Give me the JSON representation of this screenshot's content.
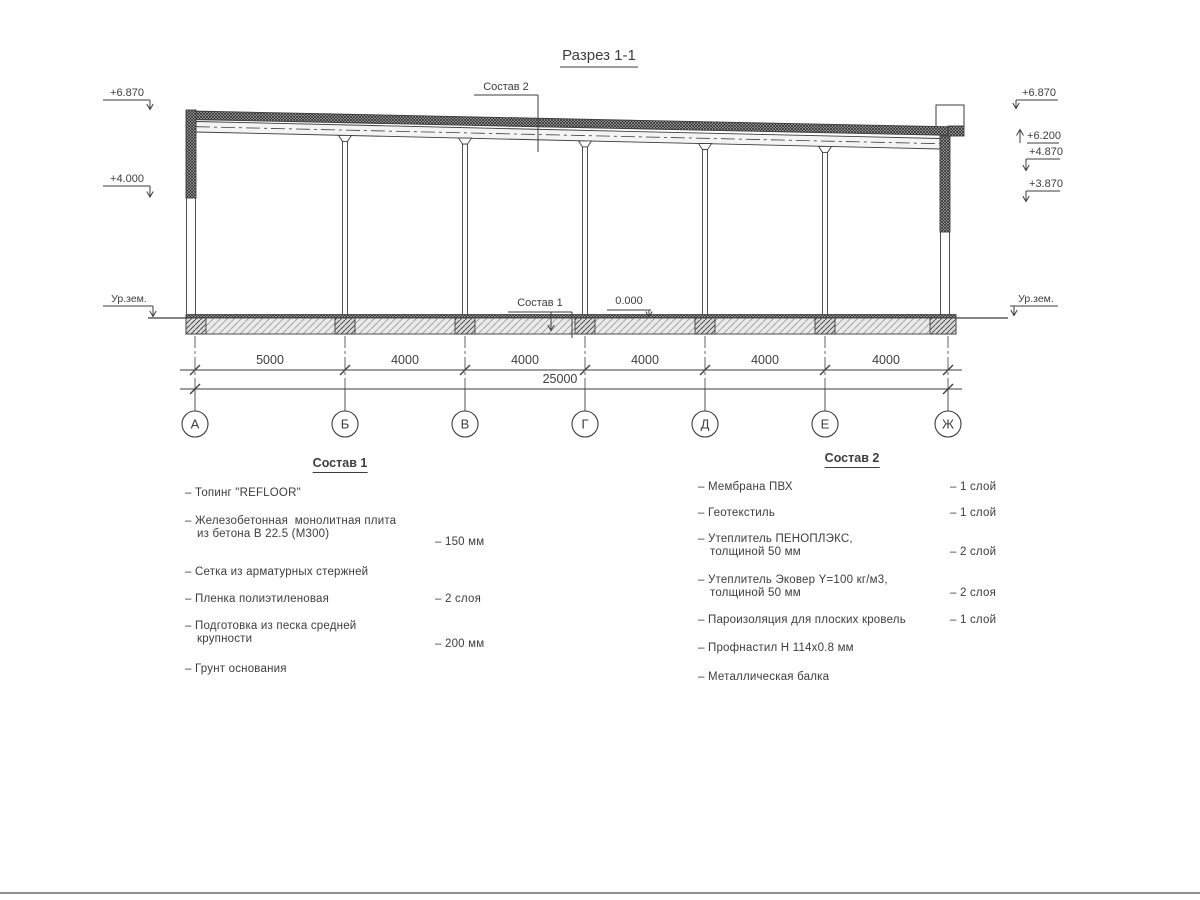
{
  "title": "Разрез 1-1",
  "callouts": {
    "sostav2": "Состав 2",
    "sostav1": "Состав 1",
    "zero": "0.000"
  },
  "elev": {
    "left": {
      "top": "+6.870",
      "mid": "+4.000",
      "ground": "Ур.зем."
    },
    "right": {
      "r1": "+6.870",
      "r2": "+6.200",
      "r3": "+4.870",
      "r4": "+3.870",
      "ground": "Ур.зем."
    }
  },
  "dims": {
    "spans": [
      "5000",
      "4000",
      "4000",
      "4000",
      "4000",
      "4000"
    ],
    "total": "25000"
  },
  "axes": [
    "А",
    "Б",
    "В",
    "Г",
    "Д",
    "Е",
    "Ж"
  ],
  "specs": {
    "s1": {
      "heading": "Состав 1",
      "i1": "– Топинг \"REFLOOR\"",
      "i2a": "– Железобетонная  монолитная плита",
      "i2b": "из бетона В 22.5 (М300)",
      "v2": "– 150 мм",
      "i3": "– Сетка из арматурных стержней",
      "i4": "– Пленка полиэтиленовая",
      "v4": "– 2 слоя",
      "i5a": "– Подготовка из песка средней",
      "i5b": "крупности",
      "v5": "– 200 мм",
      "i6": "– Грунт основания"
    },
    "s2": {
      "heading": "Состав 2",
      "i1": "– Мембрана ПВХ",
      "v1": "– 1 слой",
      "i2": "– Геотекстиль",
      "v2": "– 1 слой",
      "i3a": "– Утеплитель ПЕНОПЛЭКС,",
      "i3b": "толщиной 50 мм",
      "v3": "– 2 слой",
      "i4a": "– Утеплитель Эковер Y=100 кг/м3,",
      "i4b": "толщиной 50 мм",
      "v4": "– 2 слоя",
      "i5": "– Пароизоляция для плоских кровель",
      "v5": "– 1 слой",
      "i6": "– Профнастил Н 114х0.8 мм",
      "i7": "– Металлическая балка"
    }
  }
}
